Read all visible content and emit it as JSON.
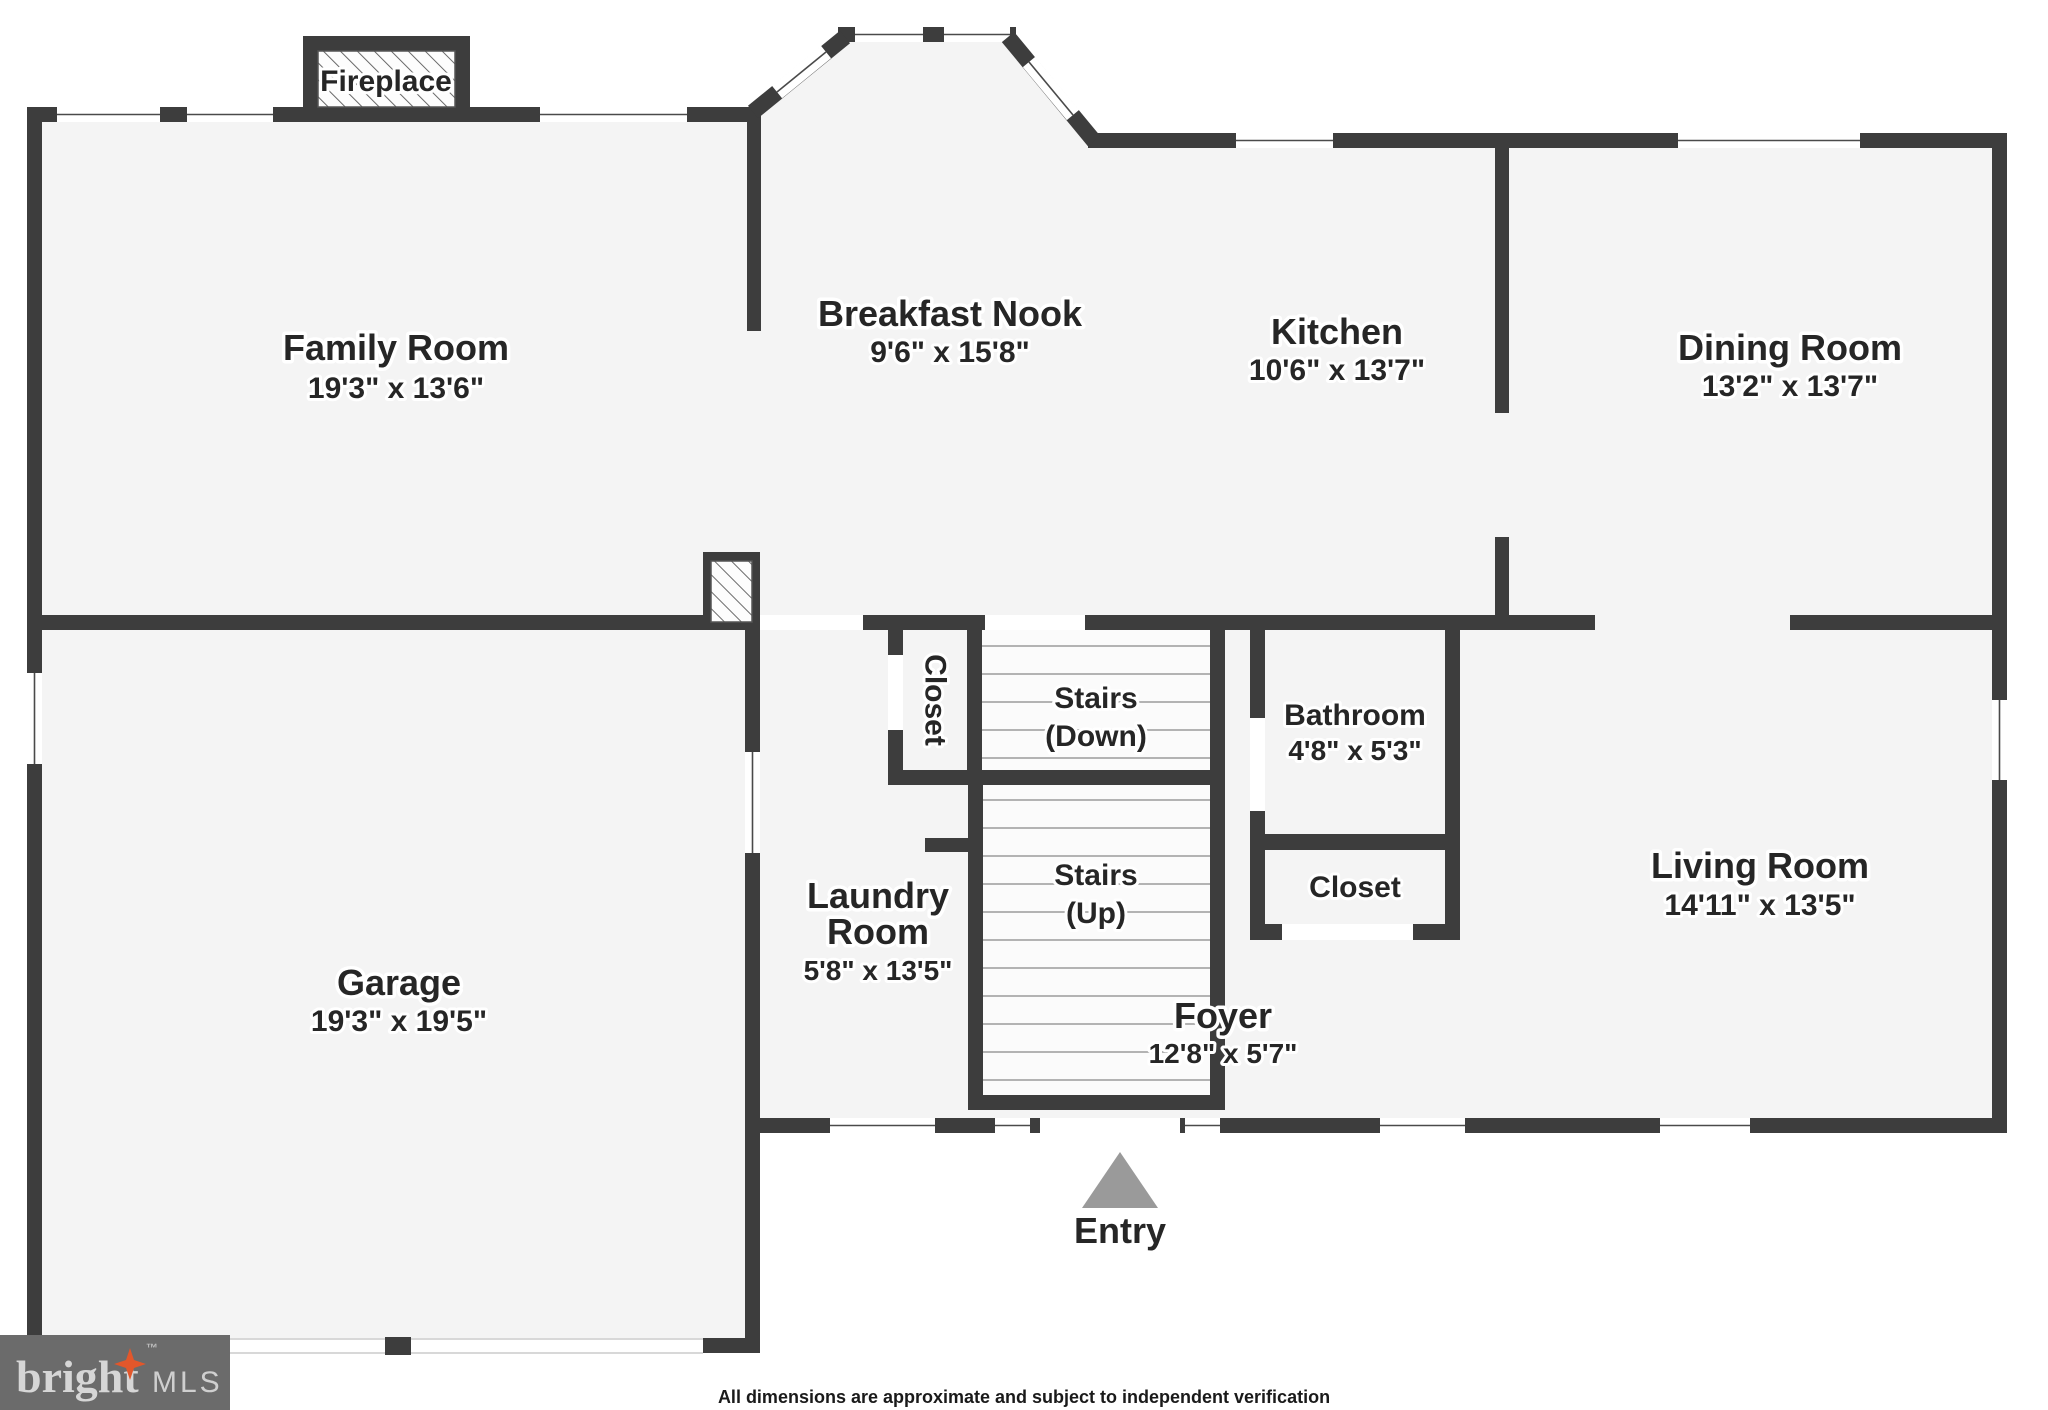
{
  "rooms": {
    "family": {
      "name": "Family Room",
      "dims": "19'3\" x 13'6\""
    },
    "breakfast": {
      "name": "Breakfast Nook",
      "dims": "9'6\" x 15'8\""
    },
    "kitchen": {
      "name": "Kitchen",
      "dims": "10'6\" x 13'7\""
    },
    "dining": {
      "name": "Dining Room",
      "dims": "13'2\" x 13'7\""
    },
    "garage": {
      "name": "Garage",
      "dims": "19'3\" x 19'5\""
    },
    "laundry": {
      "name_line1": "Laundry",
      "name_line2": "Room",
      "dims": "5'8\" x 13'5\""
    },
    "bathroom": {
      "name": "Bathroom",
      "dims": "4'8\" x 5'3\""
    },
    "living": {
      "name": "Living Room",
      "dims": "14'11\" x 13'5\""
    },
    "foyer": {
      "name": "Foyer",
      "dims": "12'8\" x 5'7\""
    }
  },
  "features": {
    "fireplace": "Fireplace",
    "hall_closet": "Closet",
    "stairs_down_line1": "Stairs",
    "stairs_down_line2": "(Down)",
    "stairs_up_line1": "Stairs",
    "stairs_up_line2": "(Up)",
    "bath_closet": "Closet",
    "entry": "Entry"
  },
  "footer": {
    "disclaimer": "All dimensions are approximate and subject to independent verification"
  },
  "logo": {
    "brand": "bright",
    "tm": "™",
    "suffix": "MLS"
  },
  "colors": {
    "wall": "#3d3d3d",
    "floor": "#f4f4f4",
    "background": "#ffffff",
    "logo_background": "#6b6b6b",
    "logo_star": "#e2572b",
    "entry_marker": "#9a9a9a"
  }
}
